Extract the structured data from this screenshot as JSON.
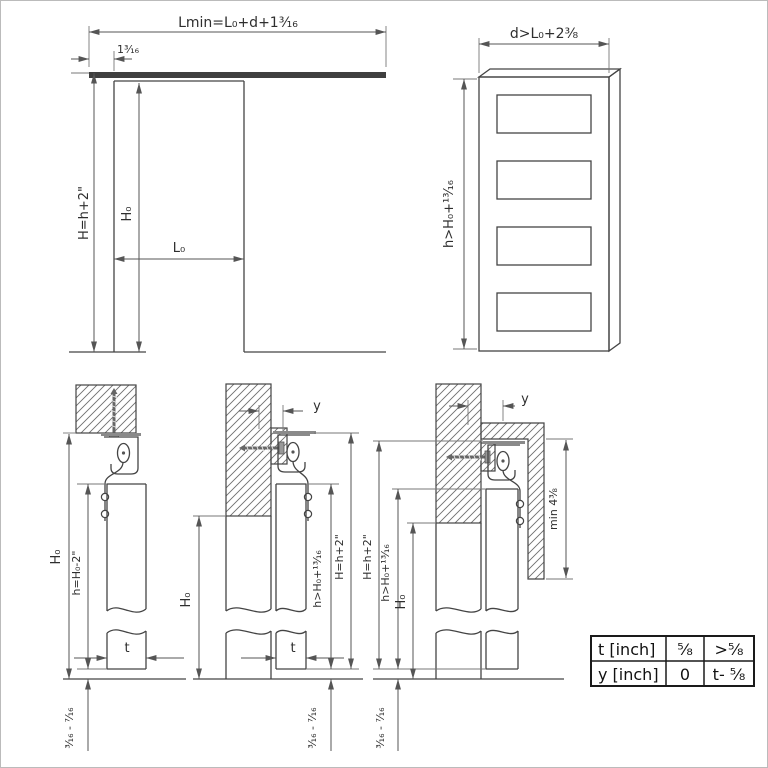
{
  "diagram": {
    "title": "sliding-door-mounting-dimensions",
    "fig_opening": {
      "dim_lmin": "Lmin=L₀+d+1³⁄₁₆",
      "dim_offset": "1³⁄₁₆",
      "dim_H": "H=h+2\"",
      "dim_H0": "H₀",
      "dim_L0": "L₀"
    },
    "fig_door": {
      "dim_d": "d>L₀+2³⁄₈",
      "dim_h": "h>H₀+¹³⁄₁₆"
    },
    "detail_ceiling": {
      "dim_H0": "H₀",
      "dim_h": "h=H₀-2\"",
      "dim_t": "t",
      "dim_gap": "³⁄₁₆ - ⁷⁄₁₆"
    },
    "detail_wall": {
      "dim_y": "y",
      "dim_H0": "H₀",
      "dim_h": "h>H₀+¹³⁄₁₆",
      "dim_H": "H=h+2\"",
      "dim_t": "t",
      "dim_gap": "³⁄₁₆ - ⁷⁄₁₆"
    },
    "detail_fascia": {
      "dim_y": "y",
      "dim_min": "min 4³⁄₈",
      "dim_H": "H=h+2\"",
      "dim_h": "h>H₀+¹³⁄₁₆",
      "dim_H0": "H₀",
      "dim_gap": "³⁄₁₆ - ⁷⁄₁₆"
    },
    "table": {
      "r1c1": "t [inch]",
      "r1c2": "⁵⁄₈",
      "r1c3": ">⁵⁄₈",
      "r2c1": "y [inch]",
      "r2c2": "0",
      "r2c3": "t- ⁵⁄₈"
    }
  }
}
